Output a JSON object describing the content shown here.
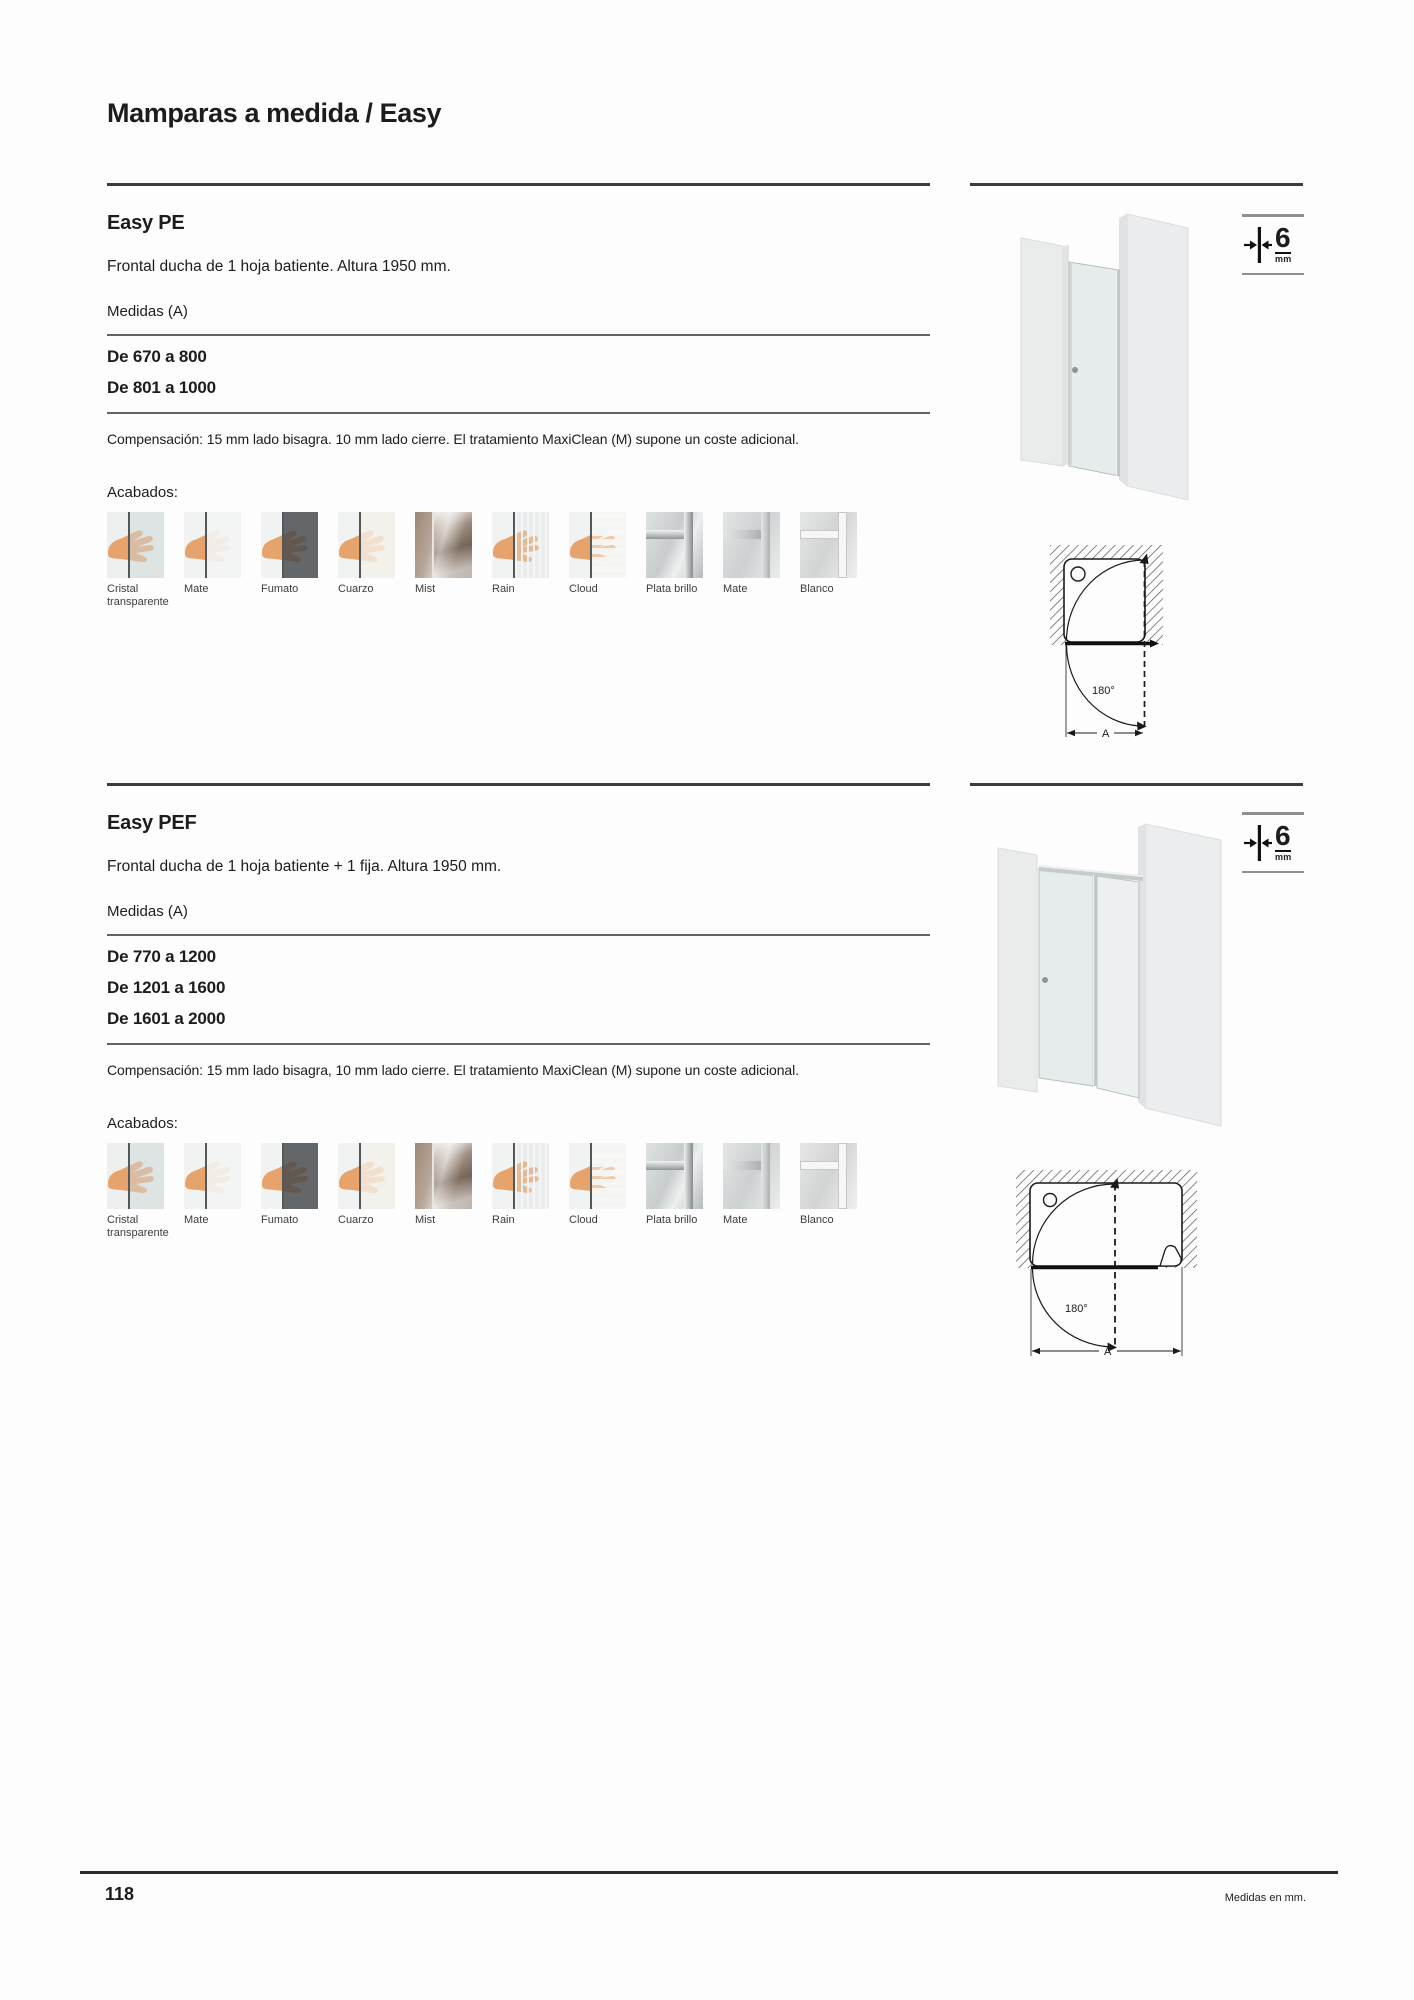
{
  "page": {
    "title": "Mamparas a medida / Easy"
  },
  "footer": {
    "page_number": "118",
    "units_note": "Medidas en mm."
  },
  "glass_icon": {
    "value": "6",
    "unit": "mm"
  },
  "diagram": {
    "angle": "180°",
    "dimension": "A"
  },
  "swatches": [
    {
      "label": "Cristal transparente",
      "kind": "clear"
    },
    {
      "label": "Mate",
      "kind": "mate"
    },
    {
      "label": "Fumato",
      "kind": "fumato"
    },
    {
      "label": "Cuarzo",
      "kind": "cuarzo"
    },
    {
      "label": "Mist",
      "kind": "mist"
    },
    {
      "label": "Rain",
      "kind": "rain"
    },
    {
      "label": "Cloud",
      "kind": "cloud"
    },
    {
      "label": "Plata brillo",
      "kind": "plata-brillo"
    },
    {
      "label": "Mate",
      "kind": "mate-profile"
    },
    {
      "label": "Blanco",
      "kind": "blanco"
    }
  ],
  "sections": [
    {
      "heading": "Easy PE",
      "description": "Frontal ducha de 1 hoja batiente. Altura 1950 mm.",
      "measures_label": "Medidas (A)",
      "measures": [
        "De 670 a 800",
        "De 801 a 1000"
      ],
      "compensation": "Compensación: 15 mm lado bisagra. 10 mm lado cierre. El tratamiento MaxiClean (M) supone un coste adicional.",
      "finishes_label": "Acabados:"
    },
    {
      "heading": "Easy PEF",
      "description": "Frontal ducha de 1 hoja batiente + 1 fija. Altura 1950 mm.",
      "measures_label": "Medidas (A)",
      "measures": [
        "De 770 a 1200",
        "De 1201 a 1600",
        "De 1601 a 2000"
      ],
      "compensation": "Compensación: 15 mm lado bisagra, 10 mm lado cierre. El tratamiento MaxiClean (M) supone un coste adicional.",
      "finishes_label": "Acabados:"
    }
  ]
}
